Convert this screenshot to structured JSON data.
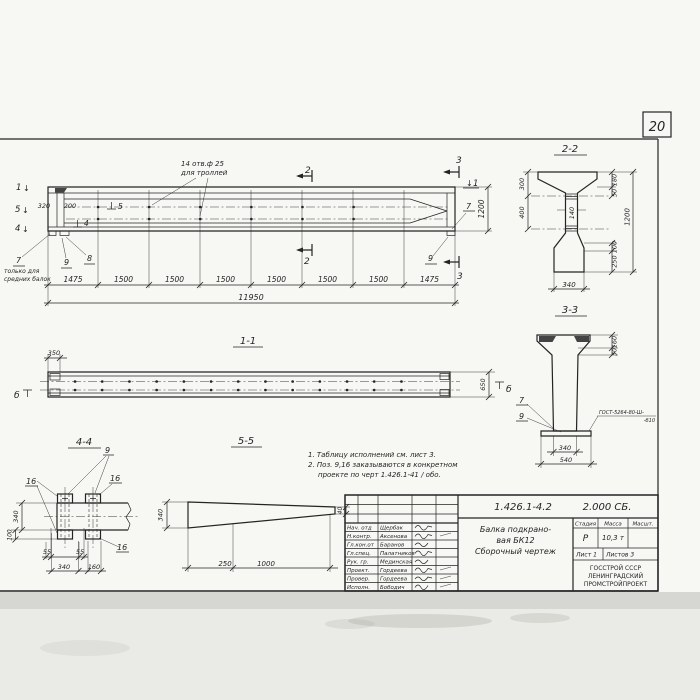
{
  "sheet": {
    "page_number": "20"
  },
  "colors": {
    "paper": "#f7f7f4",
    "ink": "#242424",
    "scan_shadow": "#d6d6d2"
  },
  "icons": {
    "down_arrow": "↓"
  },
  "elevation": {
    "hole_note1": "14 отв.ф 25",
    "hole_note2": "для троллей",
    "view1": "1",
    "view5": "5",
    "view4": "4",
    "pos5": "5",
    "pos4": "4",
    "dim320": "320",
    "dim200": "200",
    "callout7": "7",
    "callout9": "9",
    "callout8": "8",
    "cut2": "2",
    "cut3": "3",
    "note_left1": "только для",
    "note_left2": "средних балок",
    "dim_height": "1200",
    "segs": [
      "1475",
      "1500",
      "1500",
      "1500",
      "1500",
      "1500",
      "1500",
      "1475"
    ],
    "total": "11950"
  },
  "section22": {
    "title": "2-2",
    "d300": "300",
    "d400": "400",
    "d180": "180",
    "d50": "50",
    "d1200": "1200",
    "d100": "100",
    "d250": "250",
    "d140": "140",
    "d340": "340"
  },
  "section33": {
    "title": "3-3",
    "d160": "160",
    "d30": "30",
    "d340": "340",
    "d540": "540",
    "c7": "7",
    "c9": "9",
    "weld1": "ГОСТ-5264-80-Ш-",
    "weld2": "-б10"
  },
  "section11": {
    "title": "1-1",
    "d350": "350",
    "d650": "650",
    "mark_b": "б"
  },
  "section44": {
    "title": "4-4",
    "c9": "9",
    "c16": "16",
    "d340v": "340",
    "d100": "100",
    "d55a": "55",
    "d55b": "55",
    "d340h": "340",
    "d160": "160"
  },
  "section55": {
    "title": "5-5",
    "d340": "340",
    "d40": "40",
    "d250": "250",
    "d1000": "1000"
  },
  "notes": {
    "line1": "1. Таблицу исполнений см. лист 3.",
    "line2": "2. Поз. 9,16 заказываются в конкретном",
    "line3": "проекте по черт 1.426.1-41 / обо."
  },
  "titleblock": {
    "doc": "1.426.1-4.2",
    "doc2": "2.000 СБ.",
    "t1": "Балка подкрано-",
    "t2": "вая БК12",
    "t3": "Сборочный чертеж",
    "h_stage": "Стадия",
    "h_mass": "Масса",
    "h_scale": "Масшт.",
    "stage": "Р",
    "mass": "10,3 т",
    "sheet": "Лист 1",
    "sheets": "Листов 3",
    "org1": "ГОССТРОЙ СССР",
    "org2": "ЛЕНИНГРАДСКИЙ",
    "org3": "ПРОМСТРОЙПРОЕКТ",
    "roles": [
      "Нач. отд",
      "Н.контр.",
      "Гл.кон.от",
      "Гл.спец.",
      "Рук. гр.",
      "Проект.",
      "Провер.",
      "Исполн."
    ],
    "names": [
      "Щербак",
      "Аксенова",
      "Баранов",
      "Палатников",
      "Мединская",
      "Гордеева",
      "Гордеева",
      "Бободич"
    ]
  }
}
